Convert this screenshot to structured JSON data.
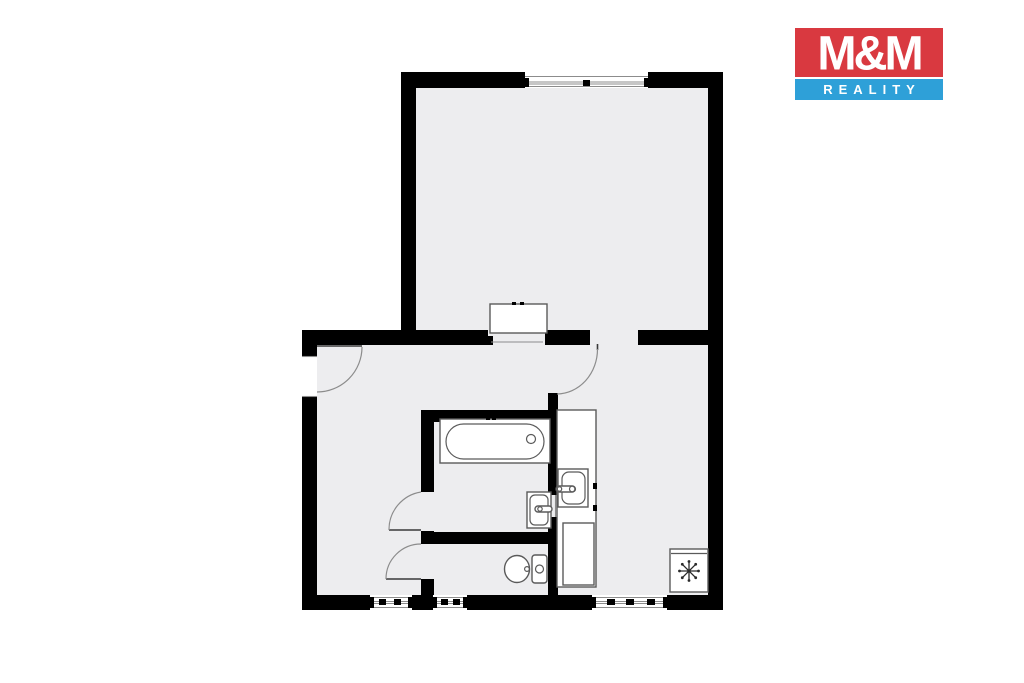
{
  "logo": {
    "title": "M&M",
    "subtitle": "REALITY",
    "colors": {
      "title_bg": "#d93940",
      "subtitle_bg": "#2ea0d8",
      "text": "#ffffff"
    }
  },
  "floorplan": {
    "colors": {
      "wall": "#000000",
      "floor": "#ededef",
      "fixture_outline": "#5a5a5a",
      "door_arc": "#8c8c8c"
    },
    "fixtures": [
      "bathtub",
      "washbasin",
      "toilet",
      "kitchen-counter",
      "kitchen-sink",
      "base-cabinet",
      "refrigerator",
      "wardrobe-cabinet"
    ],
    "icons": {
      "refrigerator_symbol": "snowflake-icon"
    },
    "doors_count": 4,
    "windows_count": 4
  }
}
